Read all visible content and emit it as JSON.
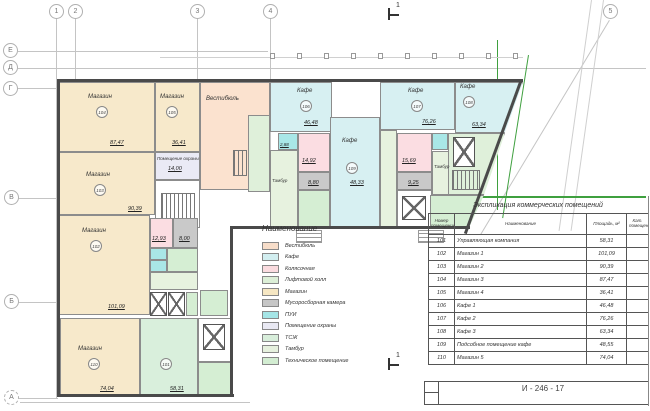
{
  "sheet": {
    "doc_number": "И - 246 - 17"
  },
  "axes": {
    "top": [
      "1",
      "2",
      "3",
      "4",
      "5"
    ],
    "left": [
      "Е",
      "Д",
      "Г",
      "В",
      "Б",
      "А"
    ],
    "section_label": "1"
  },
  "legend": {
    "title": "Наименование",
    "items": [
      {
        "label": "Вестибюль",
        "color": "#f7ddc9"
      },
      {
        "label": "Кафе",
        "color": "#d2eef0"
      },
      {
        "label": "Колясочная",
        "color": "#fadbdf"
      },
      {
        "label": "Лифтовой холл",
        "color": "#dcefd7"
      },
      {
        "label": "Магазин",
        "color": "#f6e7c3"
      },
      {
        "label": "Мусоросборная камера",
        "color": "#c6c6c6"
      },
      {
        "label": "ПУИ",
        "color": "#a5e5e6"
      },
      {
        "label": "Помещение охраны",
        "color": "#e9e9f3"
      },
      {
        "label": "ТСЖ",
        "color": "#d8eedb"
      },
      {
        "label": "Тамбур",
        "color": "#e6f1de"
      },
      {
        "label": "Техническое помещение",
        "color": "#d3edd2"
      }
    ]
  },
  "table": {
    "title": "Экспликация коммерческих помещений",
    "headers": {
      "num": "Номер помещения",
      "name": "Наименование",
      "area": "Площадь, м²",
      "cat": "Кат. помещения"
    },
    "rows": [
      {
        "num": "101",
        "name": "Управляющая компания",
        "area": "58,31"
      },
      {
        "num": "102",
        "name": "Магазин 1",
        "area": "101,09"
      },
      {
        "num": "103",
        "name": "Магазин 2",
        "area": "90,39"
      },
      {
        "num": "104",
        "name": "Магазин 3",
        "area": "87,47"
      },
      {
        "num": "105",
        "name": "Магазин 4",
        "area": "36,41"
      },
      {
        "num": "106",
        "name": "Кафе 1",
        "area": "46,48"
      },
      {
        "num": "107",
        "name": "Кафе 2",
        "area": "76,26"
      },
      {
        "num": "108",
        "name": "Кафе 3",
        "area": "63,34"
      },
      {
        "num": "109",
        "name": "Подсобное помещение кафе",
        "area": "48,55"
      },
      {
        "num": "110",
        "name": "Магазин 5",
        "area": "74,04"
      }
    ]
  },
  "plan": {
    "rooms": {
      "m104": {
        "name": "Магазин",
        "num": "104",
        "area": "87,47"
      },
      "m105": {
        "name": "Магазин",
        "num": "105",
        "area": "36,41"
      },
      "m103": {
        "name": "Магазин",
        "num": "103",
        "area": "90,39"
      },
      "m102": {
        "name": "Магазин",
        "num": "102",
        "area": "101,09"
      },
      "m110": {
        "name": "Магазин",
        "num": "110",
        "area": "74,04"
      },
      "vest": {
        "name": "Вестибюль"
      },
      "okhr": {
        "name": "Помещение охраны",
        "area": "14,00"
      },
      "r101": {
        "num": "101",
        "area": "58,31"
      },
      "cafe106": {
        "name": "Кафе",
        "num": "106",
        "area": "46,48"
      },
      "cafe107": {
        "name": "Кафе",
        "num": "107",
        "area": "76,26"
      },
      "cafe108": {
        "name": "Кафе",
        "num": "108",
        "area": "63,34"
      },
      "cafe109": {
        "name": "Кафе",
        "num": "109",
        "area": "48,33"
      },
      "kol1": {
        "area": "12,93"
      },
      "mus1": {
        "area": "8,00"
      },
      "kol2": {
        "area": "14,92"
      },
      "mus2": {
        "area": "8,80"
      },
      "kol3": {
        "area": "15,69"
      },
      "mus3": {
        "area": "9,25"
      },
      "pui1": {
        "area": "2,88"
      },
      "tambur1": {
        "name": "Тамбур"
      },
      "tambur2": {
        "name": "Тамбур"
      }
    }
  }
}
